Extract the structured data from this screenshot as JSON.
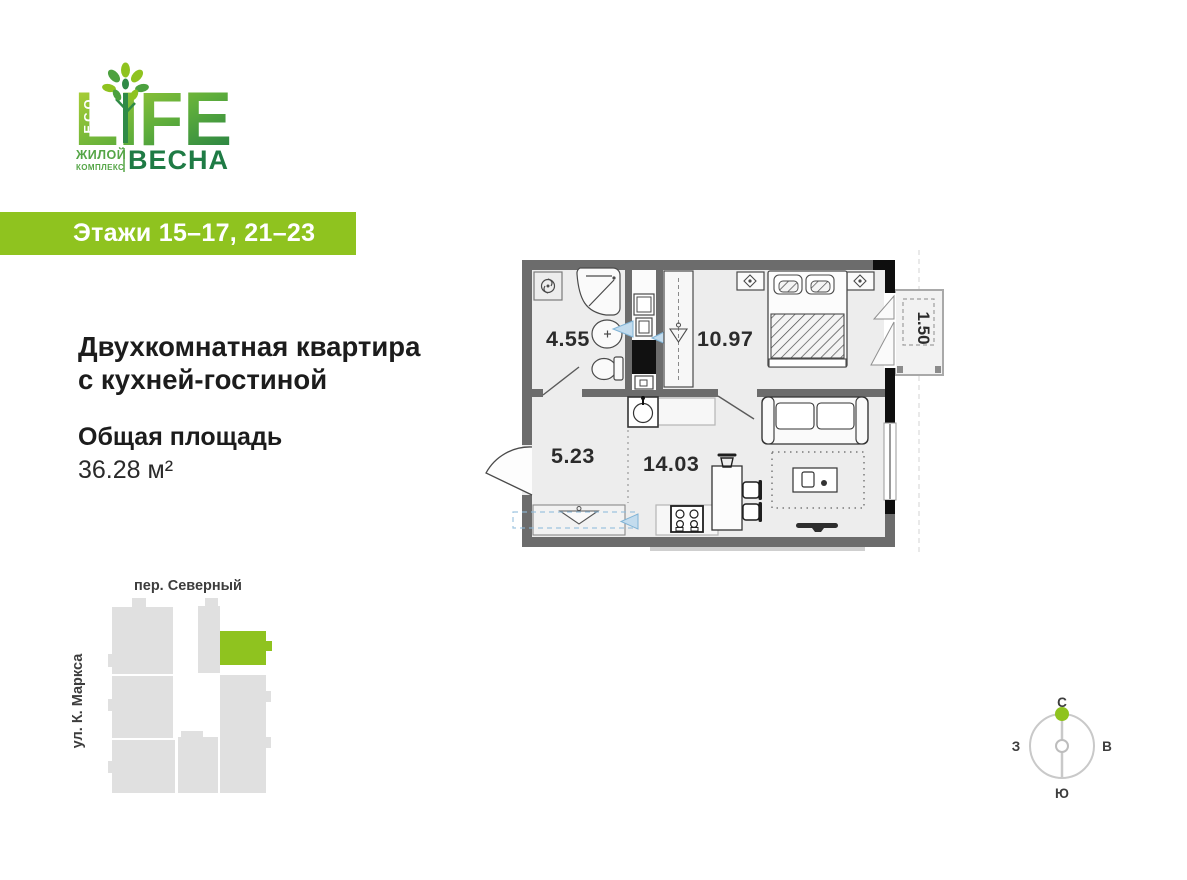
{
  "logo": {
    "life_letters": "LIFE",
    "eco": "ECO",
    "complex_line1": "ЖИЛОЙ",
    "complex_line2": "КОМПЛЕКС",
    "brand": "ВЕСНА"
  },
  "banner": {
    "floors_label": "Этажи 15–17, 21–23"
  },
  "apartment": {
    "title_line1": "Двухкомнатная квартира",
    "title_line2": "с кухней-гостиной",
    "total_area_label": "Общая площадь",
    "total_area_value": "36.28 м²"
  },
  "floorplan": {
    "rooms": [
      {
        "name": "bathroom",
        "area": "4.55"
      },
      {
        "name": "bedroom",
        "area": "10.97"
      },
      {
        "name": "hallway",
        "area": "5.23"
      },
      {
        "name": "kitchen-living",
        "area": "14.03"
      },
      {
        "name": "balcony",
        "area": "1.50"
      }
    ]
  },
  "sitemap": {
    "street_top": "пер. Северный",
    "street_left": "ул. К. Маркса"
  },
  "compass": {
    "north": "С",
    "south": "Ю",
    "west": "З",
    "east": "В"
  },
  "colors": {
    "accent_green": "#8FC31F",
    "logo_dark_green": "#1F7B45",
    "building_gray": "#E0E0E0",
    "wall_gray": "#6C6C6C"
  }
}
